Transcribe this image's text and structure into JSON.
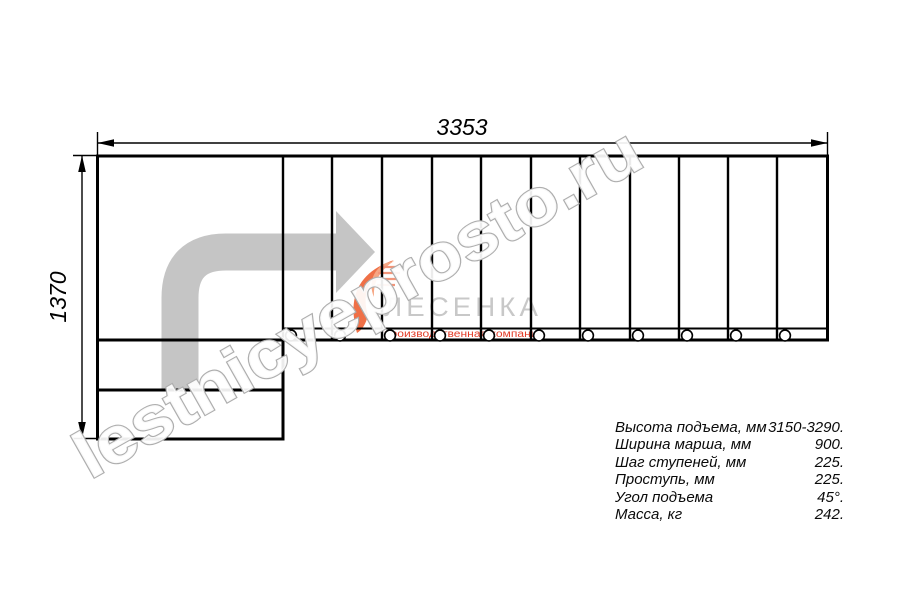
{
  "dimensions": {
    "width_label": "3353",
    "height_label": "1370"
  },
  "watermark": {
    "text": "lestnicyeprosto.ru"
  },
  "logo": {
    "name": "ЛЕСЕНКА",
    "tagline": "производственная компания"
  },
  "specs": {
    "rows": [
      {
        "label": "Высота подъема, мм",
        "value": "3150-3290."
      },
      {
        "label": "Ширина марша, мм",
        "value": "900."
      },
      {
        "label": "Шаг ступеней, мм",
        "value": "225."
      },
      {
        "label": "Проступь, мм",
        "value": "225."
      },
      {
        "label": "Угол подъема",
        "value": "45°."
      },
      {
        "label": "Масса, кг",
        "value": "242."
      }
    ]
  },
  "drawing": {
    "tread_xs": [
      283,
      332,
      382,
      432,
      481,
      531,
      580,
      630,
      679,
      728,
      777
    ],
    "circle_xs": [
      291,
      340,
      390,
      440,
      489,
      539,
      588,
      638,
      687,
      736,
      785
    ],
    "colors": {
      "line": "#000000",
      "direction_arrow": "#c5c5c5",
      "watermark_outline": "#aeaeae",
      "logo_orange": "#ef7047",
      "logo_light_orange": "#f6a683",
      "logo_gray": "#c8c8c8",
      "logo_red": "#e23c28"
    }
  }
}
